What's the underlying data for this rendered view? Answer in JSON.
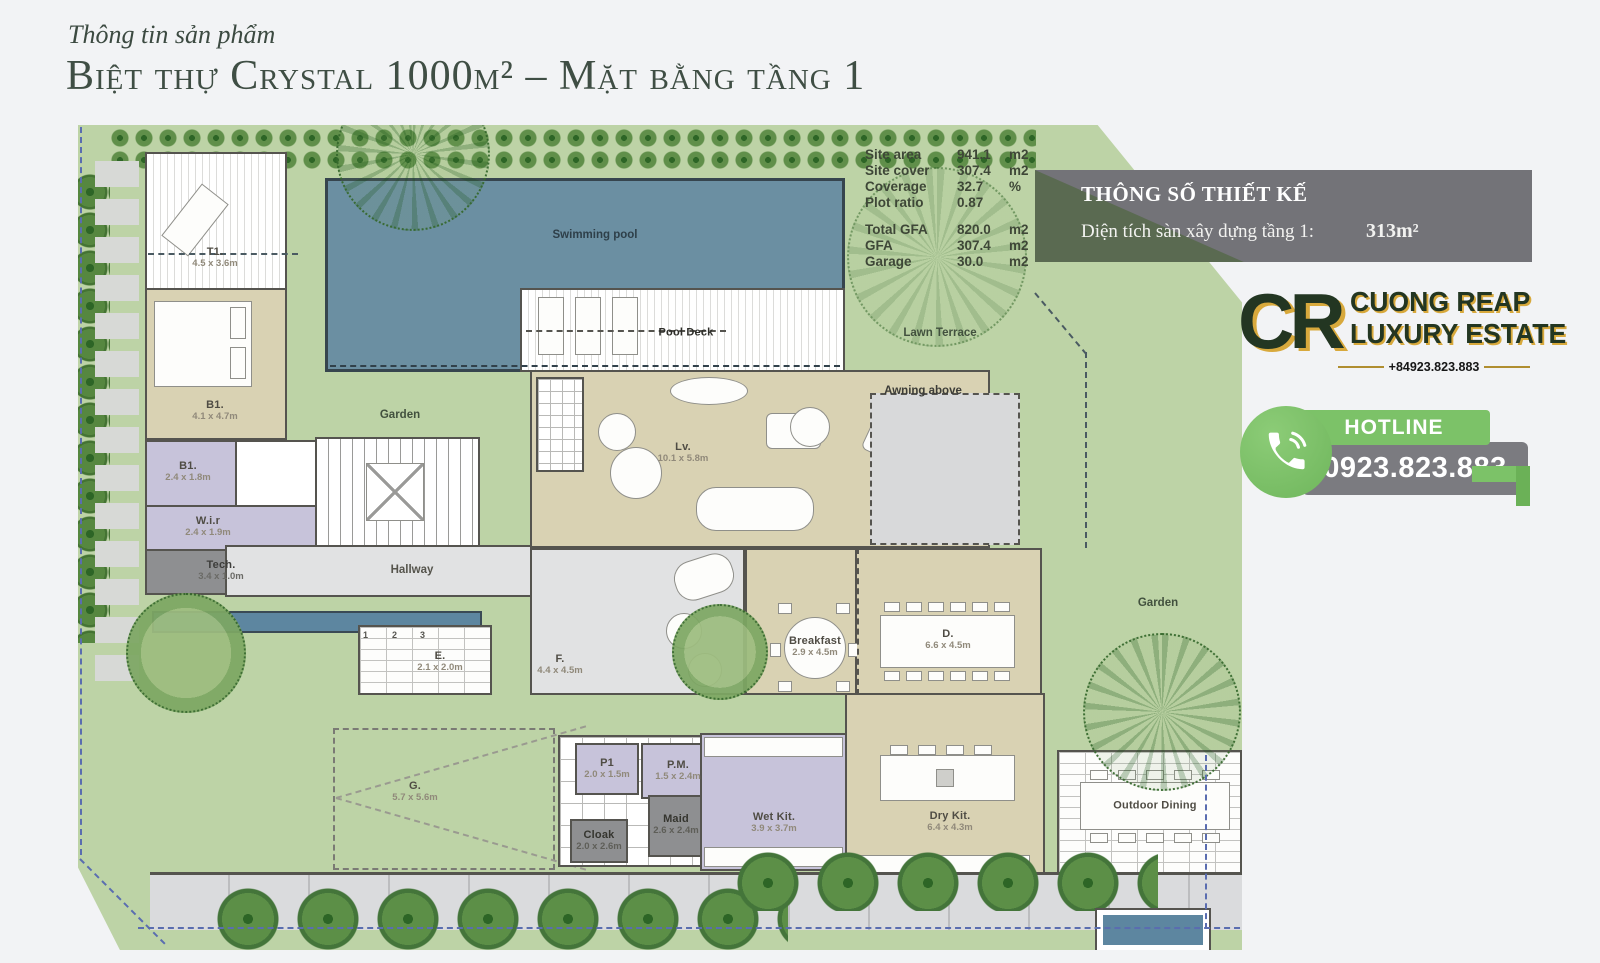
{
  "header": {
    "eyebrow": "Thông tin sản phẩm",
    "title": "Biệt thự Crystal 1000m² – Mặt bằng tầng 1"
  },
  "stats": {
    "rows": [
      {
        "label": "Site area",
        "value": "941.1",
        "unit": "m2"
      },
      {
        "label": "Site cover",
        "value": "307.4",
        "unit": "m2"
      },
      {
        "label": "Coverage",
        "value": "32.7",
        "unit": "%"
      },
      {
        "label": "Plot ratio",
        "value": "0.87",
        "unit": ""
      },
      {
        "label": "Total GFA",
        "value": "820.0",
        "unit": "m2"
      },
      {
        "label": "GFA",
        "value": "307.4",
        "unit": "m2"
      },
      {
        "label": "Garage",
        "value": "30.0",
        "unit": "m2"
      }
    ]
  },
  "design_box": {
    "title": "THÔNG SỐ THIẾT KẾ",
    "label": "Diện tích sàn xây dựng tầng 1:",
    "value": "313m²"
  },
  "brand": {
    "initials": "CR",
    "line1": "CUONG REAP",
    "line2": "LUXURY ESTATE",
    "phone_small": "+84923.823.883"
  },
  "hotline": {
    "label": "HOTLINE",
    "number": "0923.823.883"
  },
  "colors": {
    "accent_green": "#7cc268",
    "brand_green": "#233622",
    "brand_gold": "#d8a93c",
    "pool_blue": "#6b8fa2",
    "site_green": "#bdd3a6",
    "box_gray": "#737378"
  },
  "plan": {
    "swimming_pool": {
      "name": "Swimming pool"
    },
    "pool_deck": {
      "name": "Pool Deck"
    },
    "lawn_terrace": {
      "name": "Lawn Terrace"
    },
    "awning": {
      "name": "Awning above"
    },
    "garden_left": {
      "name": "Garden"
    },
    "garden_right": {
      "name": "Garden"
    },
    "hallway": {
      "name": "Hallway"
    },
    "outdoor_dining": {
      "name": "Outdoor Dining"
    },
    "t1": {
      "name": "T1.",
      "dims": "4.5 x 3.6m"
    },
    "b1": {
      "name": "B1.",
      "dims": "4.1 x 4.7m"
    },
    "bath": {
      "name": "B1.",
      "dims": "2.4 x 1.8m"
    },
    "wir": {
      "name": "W.i.r",
      "dims": "2.4 x 1.9m"
    },
    "tech": {
      "name": "Tech.",
      "dims": "3.4 x 1.0m"
    },
    "lv": {
      "name": "Lv.",
      "dims": "10.1 x 5.8m"
    },
    "f": {
      "name": "F.",
      "dims": "4.4 x 4.5m"
    },
    "e": {
      "name": "E.",
      "dims": "2.1 x 2.0m"
    },
    "breakfast": {
      "name": "Breakfast",
      "dims": "2.9 x 4.5m"
    },
    "d": {
      "name": "D.",
      "dims": "6.6 x 4.5m"
    },
    "g": {
      "name": "G.",
      "dims": "5.7 x 5.6m"
    },
    "p1": {
      "name": "P1",
      "dims": "2.0 x 1.5m"
    },
    "pm": {
      "name": "P.M.",
      "dims": "1.5 x 2.4m"
    },
    "cloak": {
      "name": "Cloak",
      "dims": "2.0 x 2.6m"
    },
    "maid": {
      "name": "Maid",
      "dims": "2.6 x 2.4m"
    },
    "wet_kit": {
      "name": "Wet Kit.",
      "dims": "3.9 x 3.7m"
    },
    "dry_kit": {
      "name": "Dry Kit.",
      "dims": "6.4 x 4.3m"
    },
    "parking": [
      "1",
      "2",
      "3"
    ]
  }
}
